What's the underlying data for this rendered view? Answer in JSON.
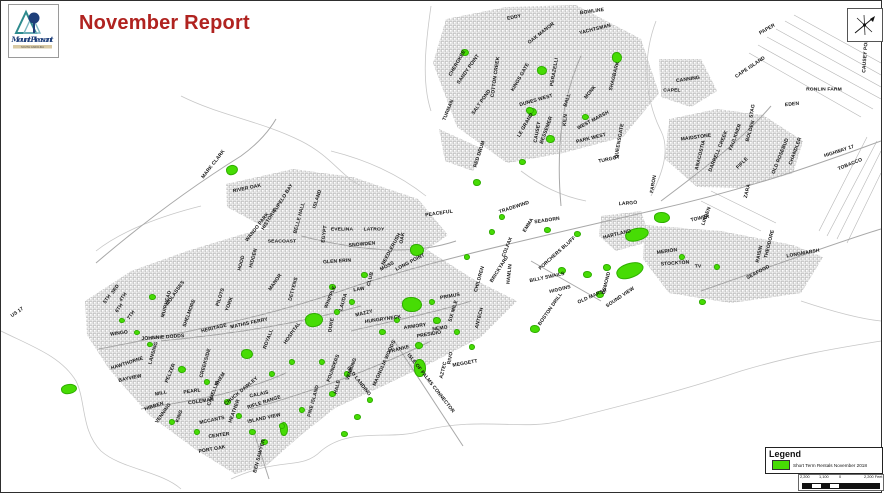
{
  "header": {
    "title": "November Report",
    "title_color": "#B02320"
  },
  "logo": {
    "line1": "Mount Pleasant",
    "line2": "SOUTH CAROLINA"
  },
  "legend": {
    "title": "Legend",
    "item_label": "Short Term Rentals November 2018",
    "swatch_color": "#47DC04"
  },
  "scale_bar": {
    "labels": [
      "2,200",
      "1,100",
      "0",
      "2,200 Feet"
    ]
  },
  "north_arrow": {
    "name": "north-arrow"
  },
  "map": {
    "colors": {
      "rental_green": "#47DC04",
      "parcel_gray": "#b9b9b9",
      "road_gray": "#a8a8a8",
      "boundary_gray": "#c7c7c7"
    },
    "labels": [
      [
        "BOWLINE",
        591,
        10,
        -8
      ],
      [
        "EDDY",
        513,
        16,
        -12
      ],
      [
        "OAK MANOR",
        540,
        32,
        -38
      ],
      [
        "YACHTSMAN",
        594,
        28,
        -14
      ],
      [
        "CHEROKEE",
        456,
        62,
        -60
      ],
      [
        "SANDY POINT",
        467,
        68,
        -55
      ],
      [
        "COTTON CREEK",
        494,
        76,
        -82
      ],
      [
        "SALT POND",
        480,
        101,
        -55
      ],
      [
        "KINGS GATE",
        519,
        76,
        -60
      ],
      [
        "DUNES WEST",
        535,
        99,
        -16
      ],
      [
        "PERAZELLI",
        553,
        71,
        -80
      ],
      [
        "BALL",
        566,
        99,
        -72
      ],
      [
        "MONK",
        589,
        91,
        -52
      ],
      [
        "SHAGBARK",
        613,
        75,
        -76
      ],
      [
        "KILN",
        564,
        119,
        -84
      ],
      [
        "WEST MARSH",
        592,
        119,
        -28
      ],
      [
        "TURMAN",
        447,
        109,
        -68
      ],
      [
        "CAUSEY",
        536,
        131,
        -80
      ],
      [
        "LE GRAND",
        524,
        124,
        -60
      ],
      [
        "BESSEMER",
        545,
        129,
        -70
      ],
      [
        "RED DRUM",
        478,
        153,
        -72
      ],
      [
        "PARK WEST",
        590,
        137,
        -14
      ],
      [
        "QUEENSGATE",
        618,
        140,
        -80
      ],
      [
        "TURGOT",
        608,
        158,
        -12
      ],
      [
        "CANNING",
        687,
        78,
        -8
      ],
      [
        "CAPEL",
        671,
        89,
        0
      ],
      [
        "PAPER",
        766,
        28,
        -30
      ],
      [
        "CAPE ISLAND",
        749,
        66,
        -34
      ],
      [
        "RONLIN FARM",
        823,
        88,
        0
      ],
      [
        "EDEN",
        791,
        103,
        -6
      ],
      [
        "STAG",
        751,
        110,
        -80
      ],
      [
        "CAUSEY POND",
        864,
        53,
        -86
      ],
      [
        "MAIDSTONE",
        695,
        136,
        -8
      ],
      [
        "ANACOSTIA",
        699,
        154,
        -76
      ],
      [
        "DARRELL CREEK",
        717,
        150,
        -68
      ],
      [
        "FAULKNER",
        734,
        136,
        -70
      ],
      [
        "BOLDEN",
        749,
        130,
        -74
      ],
      [
        "FIFLE",
        741,
        162,
        -45
      ],
      [
        "OLD ROSEBUD",
        779,
        155,
        -68
      ],
      [
        "CHANDLER",
        794,
        150,
        -70
      ],
      [
        "HIGHWAY 17",
        838,
        150,
        -18
      ],
      [
        "TOBACCO",
        849,
        163,
        -22
      ],
      [
        "FARON",
        652,
        183,
        -80
      ],
      [
        "LARGO",
        627,
        202,
        -4
      ],
      [
        "HARTLAND",
        616,
        233,
        -14
      ],
      [
        "TRADEWIND",
        513,
        206,
        -18
      ],
      [
        "EMMA",
        527,
        224,
        -58
      ],
      [
        "SEABORN",
        546,
        219,
        -8
      ],
      [
        "COLFAX",
        506,
        246,
        -68
      ],
      [
        "BRICKYARD",
        498,
        268,
        -58
      ],
      [
        "PORCHERS BLUFF",
        556,
        252,
        -42
      ],
      [
        "HAMLIN",
        508,
        273,
        -84
      ],
      [
        "BILLY SWAILS",
        546,
        276,
        -12
      ],
      [
        "HIGGINS",
        559,
        288,
        -14
      ],
      [
        "OLD MARSH",
        591,
        295,
        -24
      ],
      [
        "BOSTON DRILL",
        549,
        308,
        -55
      ],
      [
        "OSMOND",
        605,
        282,
        -76
      ],
      [
        "SOUND VIEW",
        619,
        296,
        -34
      ],
      [
        "MERION",
        666,
        250,
        -8
      ],
      [
        "STOCKTON",
        674,
        262,
        -4
      ],
      [
        "TV",
        697,
        265,
        0
      ],
      [
        "LINDEN",
        705,
        215,
        -70
      ],
      [
        "TOWER",
        699,
        217,
        -12
      ],
      [
        "ZARA",
        746,
        190,
        -76
      ],
      [
        "THEODORE",
        768,
        243,
        -76
      ],
      [
        "RAISIN",
        758,
        253,
        -78
      ],
      [
        "SEAFOOD",
        757,
        271,
        -28
      ],
      [
        "LONGMARSH",
        802,
        252,
        -10
      ],
      [
        "MARK CLARK",
        212,
        163,
        -52
      ],
      [
        "RIVER OAK",
        246,
        187,
        -12
      ],
      [
        "TUPELO BAY",
        282,
        197,
        -58
      ],
      [
        "BELLE HALL",
        298,
        217,
        -75
      ],
      [
        "ISLAND",
        316,
        198,
        -72
      ],
      [
        "HISTORIC",
        268,
        218,
        -58
      ],
      [
        "WANDO PARK",
        256,
        226,
        -52
      ],
      [
        "SEACOAST",
        281,
        240,
        0
      ],
      [
        "EVELINA",
        341,
        228,
        0
      ],
      [
        "LATROY",
        373,
        228,
        0
      ],
      [
        "SNOWDEN",
        361,
        243,
        -5
      ],
      [
        "NEEDLERUSH",
        390,
        248,
        -62
      ],
      [
        "EGYPT",
        323,
        233,
        -82
      ],
      [
        "GLEN ERIN",
        336,
        260,
        -4
      ],
      [
        "MOSS",
        386,
        265,
        -28
      ],
      [
        "OAK",
        401,
        237,
        -80
      ],
      [
        "LONG POINT",
        409,
        261,
        -28
      ],
      [
        "PEACEFUL",
        438,
        212,
        -8
      ],
      [
        "CLUB",
        369,
        278,
        -76
      ],
      [
        "LAW",
        358,
        288,
        -8
      ],
      [
        "WHIPPLE",
        329,
        296,
        -68
      ],
      [
        "LAUDA",
        342,
        301,
        -74
      ],
      [
        "MAZZY",
        363,
        312,
        -14
      ],
      [
        "HUNGRYNECK",
        382,
        318,
        -8
      ],
      [
        "ARMORY",
        414,
        325,
        -8
      ],
      [
        "PRESIDIO",
        428,
        333,
        -10
      ],
      [
        "PRIMUS",
        449,
        295,
        -10
      ],
      [
        "SIX MILE",
        452,
        310,
        -74
      ],
      [
        "CHILDREN",
        478,
        278,
        -74
      ],
      [
        "ANTECH",
        478,
        317,
        -76
      ],
      [
        "NEMO",
        439,
        327,
        -8
      ],
      [
        "DUKE",
        330,
        324,
        -80
      ],
      [
        "FRANKE",
        398,
        348,
        -14
      ],
      [
        "MAGNOLIA WOODS",
        383,
        362,
        -66
      ],
      [
        "ISLE OF PALMS CONNECTOR",
        430,
        382,
        52
      ],
      [
        "FOUNDERS",
        332,
        367,
        -70
      ],
      [
        "VENNING",
        350,
        368,
        -70
      ],
      [
        "OLD LANDING",
        358,
        380,
        52
      ],
      [
        "HALE",
        336,
        386,
        -76
      ],
      [
        "AZTEC",
        442,
        369,
        -76
      ],
      [
        "RIVO",
        449,
        357,
        -80
      ],
      [
        "MEGGETT",
        464,
        362,
        -10
      ],
      [
        "MANOR",
        274,
        281,
        -55
      ],
      [
        "DETYENS",
        292,
        288,
        -75
      ],
      [
        "HIDDEN",
        252,
        257,
        -75
      ],
      [
        "HOOD",
        240,
        262,
        -75
      ],
      [
        "MUIRHEAD",
        165,
        303,
        -75
      ],
      [
        "US 17",
        16,
        311,
        -35
      ],
      [
        "3RD",
        114,
        288,
        -55
      ],
      [
        "4TH",
        122,
        296,
        -55
      ],
      [
        "5TH",
        106,
        298,
        -55
      ],
      [
        "6TH",
        118,
        307,
        -55
      ],
      [
        "7TH",
        130,
        314,
        -55
      ],
      [
        "WINGO",
        118,
        332,
        -8
      ],
      [
        "JOHNNIE DODDS",
        162,
        336,
        -4
      ],
      [
        "MOLASSES",
        174,
        292,
        -55
      ],
      [
        "SHELMORE",
        188,
        312,
        -70
      ],
      [
        "PILOTS",
        219,
        296,
        -72
      ],
      [
        "YORK",
        228,
        303,
        -70
      ],
      [
        "HERITAGE",
        213,
        327,
        -14
      ],
      [
        "MATHIS FERRY",
        248,
        322,
        -12
      ],
      [
        "HOSPITAL",
        291,
        332,
        -55
      ],
      [
        "ROYALL",
        267,
        338,
        -70
      ],
      [
        "HAWTHORNE",
        126,
        362,
        -18
      ],
      [
        "BAYVIEW",
        129,
        377,
        -12
      ],
      [
        "LANSING",
        152,
        352,
        -74
      ],
      [
        "PELZER",
        169,
        372,
        -68
      ],
      [
        "CREEKSIDE",
        204,
        362,
        -74
      ],
      [
        "SHEM",
        219,
        378,
        -58
      ],
      [
        "MILL",
        160,
        392,
        -12
      ],
      [
        "PEARL",
        191,
        390,
        -8
      ],
      [
        "HIBBEN",
        153,
        405,
        -18
      ],
      [
        "VENNING",
        162,
        412,
        -55
      ],
      [
        "COLEMAN",
        200,
        400,
        -8
      ],
      [
        "KING",
        178,
        415,
        -70
      ],
      [
        "CHUCK DAWLEY",
        240,
        390,
        -40
      ],
      [
        "CALAIS",
        258,
        393,
        -12
      ],
      [
        "RIFLE RANGE",
        263,
        401,
        -18
      ],
      [
        "ISLAND VIEW",
        263,
        417,
        -12
      ],
      [
        "CAMELLIA",
        212,
        392,
        -70
      ],
      [
        "HEATHER",
        233,
        410,
        -70
      ],
      [
        "MCCANTS",
        211,
        419,
        -12
      ],
      [
        "CENTER",
        218,
        434,
        -8
      ],
      [
        "PORT OAK",
        211,
        448,
        -10
      ],
      [
        "BEN SAWYER",
        258,
        455,
        -75
      ],
      [
        "PINE ISLAND",
        312,
        400,
        -75
      ]
    ],
    "green_areas": [
      [
        230,
        168,
        10,
        8,
        -20
      ],
      [
        463,
        50,
        6,
        5,
        0
      ],
      [
        540,
        68,
        8,
        7,
        0
      ],
      [
        530,
        110,
        7,
        6,
        0
      ],
      [
        615,
        55,
        8,
        9,
        0
      ],
      [
        583,
        115,
        5,
        4,
        0
      ],
      [
        528,
        108,
        6,
        5,
        0
      ],
      [
        548,
        137,
        7,
        6,
        0
      ],
      [
        520,
        160,
        5,
        4,
        0
      ],
      [
        475,
        180,
        6,
        5,
        0
      ],
      [
        545,
        228,
        5,
        4,
        0
      ],
      [
        575,
        232,
        5,
        4,
        0
      ],
      [
        560,
        268,
        6,
        5,
        0
      ],
      [
        585,
        272,
        7,
        5,
        0
      ],
      [
        605,
        265,
        6,
        5,
        0
      ],
      [
        660,
        215,
        14,
        9,
        0
      ],
      [
        635,
        232,
        22,
        11,
        -15
      ],
      [
        628,
        268,
        26,
        13,
        -20
      ],
      [
        598,
        292,
        6,
        5,
        0
      ],
      [
        700,
        300,
        5,
        4,
        0
      ],
      [
        415,
        248,
        12,
        10,
        0
      ],
      [
        362,
        273,
        5,
        4,
        0
      ],
      [
        330,
        285,
        5,
        4,
        0
      ],
      [
        312,
        318,
        16,
        12,
        -10
      ],
      [
        410,
        302,
        18,
        13,
        0
      ],
      [
        435,
        318,
        6,
        5,
        0
      ],
      [
        417,
        343,
        6,
        5,
        0
      ],
      [
        533,
        327,
        8,
        6,
        0
      ],
      [
        67,
        387,
        14,
        8,
        -10
      ],
      [
        150,
        295,
        5,
        4,
        0
      ],
      [
        245,
        352,
        10,
        8,
        0
      ],
      [
        180,
        367,
        6,
        5,
        0
      ],
      [
        418,
        366,
        10,
        16,
        0
      ],
      [
        282,
        427,
        6,
        12,
        0
      ],
      [
        205,
        380,
        4,
        4,
        0
      ],
      [
        225,
        400,
        5,
        4,
        0
      ],
      [
        237,
        414,
        4,
        4,
        0
      ],
      [
        250,
        430,
        5,
        4,
        0
      ],
      [
        195,
        430,
        4,
        4,
        0
      ],
      [
        170,
        420,
        4,
        4,
        0
      ],
      [
        262,
        440,
        5,
        4,
        0
      ],
      [
        280,
        424,
        4,
        4,
        0
      ],
      [
        300,
        408,
        4,
        4,
        0
      ],
      [
        330,
        392,
        5,
        4,
        0
      ],
      [
        345,
        372,
        4,
        4,
        0
      ],
      [
        355,
        415,
        5,
        4,
        0
      ],
      [
        368,
        398,
        4,
        4,
        0
      ],
      [
        342,
        432,
        5,
        4,
        0
      ],
      [
        320,
        360,
        4,
        4,
        0
      ],
      [
        290,
        360,
        4,
        4,
        0
      ],
      [
        270,
        372,
        4,
        4,
        0
      ],
      [
        135,
        330,
        4,
        3,
        0
      ],
      [
        148,
        342,
        4,
        3,
        0
      ],
      [
        120,
        318,
        4,
        3,
        0
      ],
      [
        380,
        330,
        5,
        4,
        0
      ],
      [
        395,
        318,
        4,
        4,
        0
      ],
      [
        430,
        300,
        4,
        4,
        0
      ],
      [
        455,
        330,
        4,
        4,
        0
      ],
      [
        470,
        345,
        4,
        4,
        0
      ],
      [
        350,
        300,
        4,
        4,
        0
      ],
      [
        335,
        310,
        4,
        4,
        0
      ],
      [
        680,
        255,
        4,
        4,
        0
      ],
      [
        715,
        265,
        4,
        4,
        0
      ],
      [
        500,
        215,
        4,
        4,
        0
      ],
      [
        490,
        230,
        4,
        4,
        0
      ],
      [
        465,
        255,
        4,
        4,
        0
      ]
    ]
  }
}
